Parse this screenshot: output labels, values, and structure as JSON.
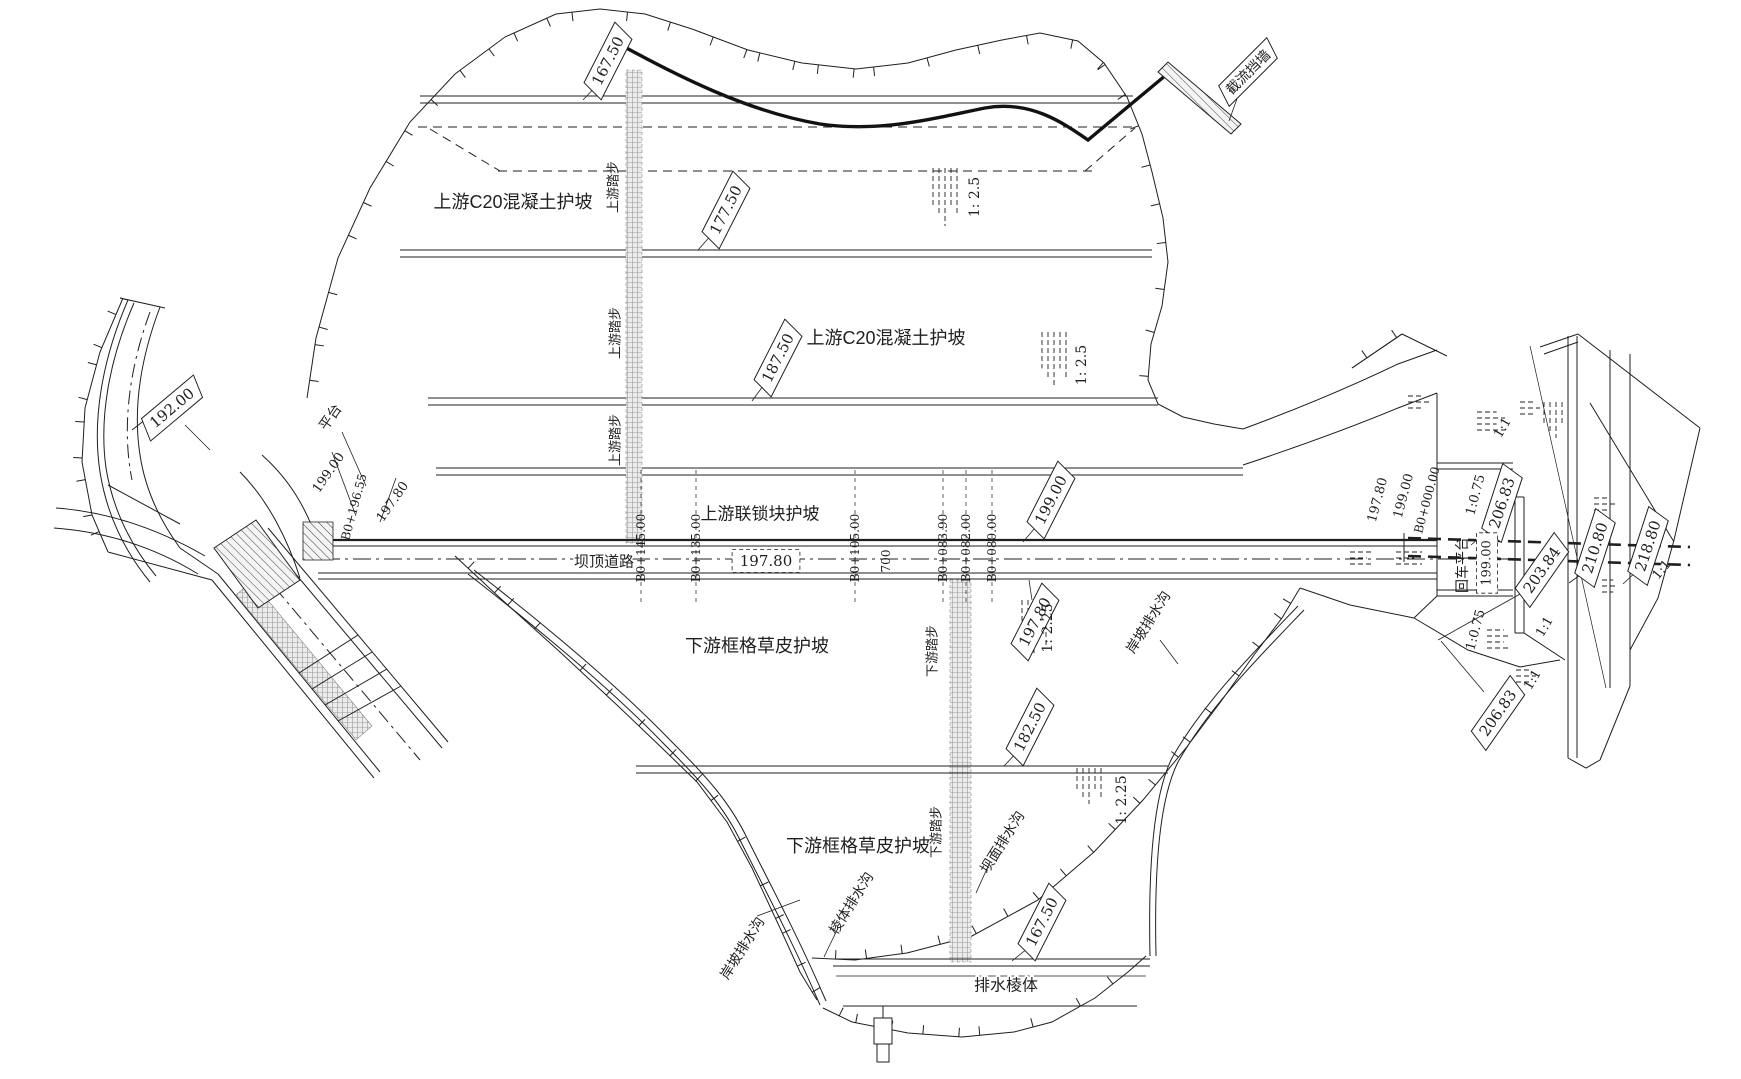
{
  "drawing": {
    "type": "engineering-plan",
    "subject": "dam plan view with spillway, crest road, slope protections and drainage",
    "ink_color": "#1f1f1f",
    "background": "#ffffff"
  },
  "labels": [
    {
      "t": "167.50",
      "x": 608,
      "y": 61,
      "r": -63,
      "s": "tag",
      "fs": 15,
      "n": "elev-tag-167-50-upstream"
    },
    {
      "t": "177.50",
      "x": 726,
      "y": 210,
      "r": -63,
      "s": "tag",
      "fs": 15,
      "n": "elev-tag-177-50"
    },
    {
      "t": "187.50",
      "x": 778,
      "y": 358,
      "r": -63,
      "s": "tag",
      "fs": 15,
      "n": "elev-tag-187-50"
    },
    {
      "t": "199.00",
      "x": 1051,
      "y": 500,
      "r": -63,
      "s": "tag",
      "fs": 15,
      "n": "elev-tag-199-00"
    },
    {
      "t": "197.80",
      "x": 1035,
      "y": 622,
      "r": -63,
      "s": "tag",
      "fs": 15,
      "n": "elev-tag-197-80-downstream"
    },
    {
      "t": "182.50",
      "x": 1030,
      "y": 727,
      "r": -63,
      "s": "tag",
      "fs": 15,
      "n": "elev-tag-182-50"
    },
    {
      "t": "167.50",
      "x": 1042,
      "y": 922,
      "r": -63,
      "s": "tag",
      "fs": 15,
      "n": "elev-tag-167-50-prism"
    },
    {
      "t": "192.00",
      "x": 172,
      "y": 408,
      "r": -40,
      "s": "tag",
      "fs": 15,
      "n": "elev-tag-192-00"
    },
    {
      "t": "206.83",
      "x": 1502,
      "y": 503,
      "r": -72,
      "s": "tag",
      "fs": 15,
      "n": "elev-tag-206-83-upper"
    },
    {
      "t": "203.84",
      "x": 1542,
      "y": 570,
      "r": -55,
      "s": "tag",
      "fs": 15,
      "n": "elev-tag-203-84"
    },
    {
      "t": "210.80",
      "x": 1595,
      "y": 548,
      "r": -72,
      "s": "tag",
      "fs": 15,
      "n": "elev-tag-210-80"
    },
    {
      "t": "218.80",
      "x": 1648,
      "y": 546,
      "r": -72,
      "s": "tag",
      "fs": 15,
      "n": "elev-tag-218-80"
    },
    {
      "t": "206.83",
      "x": 1498,
      "y": 713,
      "r": -55,
      "s": "tag",
      "fs": 15,
      "n": "elev-tag-206-83-lower"
    },
    {
      "t": "截流挡墙",
      "x": 1248,
      "y": 72,
      "r": -45,
      "s": "tag",
      "fs": 14,
      "n": "closure-wall-tag"
    },
    {
      "t": "197.80",
      "x": 766,
      "y": 561,
      "r": 0,
      "s": "dash",
      "fs": 15,
      "n": "crest-elev-box-197-80"
    },
    {
      "t": "199.00",
      "x": 1487,
      "y": 563,
      "r": -90,
      "s": "dash",
      "fs": 13,
      "n": "platform-elev-box-199-00"
    },
    {
      "t": "上游C20混凝土护坡",
      "x": 513,
      "y": 202,
      "r": 0,
      "s": "plain",
      "fs": 18,
      "n": "upstream-c20-concrete-slope-1"
    },
    {
      "t": "上游C20混凝土护坡",
      "x": 886,
      "y": 338,
      "r": 0,
      "s": "plain",
      "fs": 18,
      "n": "upstream-c20-concrete-slope-2"
    },
    {
      "t": "上游联锁块护坡",
      "x": 760,
      "y": 514,
      "r": 0,
      "s": "plain",
      "fs": 17,
      "n": "upstream-interlocking-block-slope"
    },
    {
      "t": "坝顶道路",
      "x": 604,
      "y": 562,
      "r": 0,
      "s": "plain",
      "fs": 15,
      "n": "dam-crest-road-label"
    },
    {
      "t": "下游框格草皮护坡",
      "x": 757,
      "y": 646,
      "r": 0,
      "s": "plain",
      "fs": 18,
      "n": "downstream-grid-grass-slope-1"
    },
    {
      "t": "下游框格草皮护坡",
      "x": 858,
      "y": 846,
      "r": 0,
      "s": "plain",
      "fs": 18,
      "n": "downstream-grid-grass-slope-2"
    },
    {
      "t": "排水棱体",
      "x": 1006,
      "y": 986,
      "r": 0,
      "s": "plain",
      "fs": 16,
      "n": "drainage-prism-label"
    },
    {
      "t": "上游踏步",
      "x": 613,
      "y": 187,
      "r": -90,
      "s": "plain",
      "fs": 13,
      "n": "upstream-steps-label-1"
    },
    {
      "t": "上游踏步",
      "x": 615,
      "y": 333,
      "r": -90,
      "s": "plain",
      "fs": 13,
      "n": "upstream-steps-label-2"
    },
    {
      "t": "上游踏步",
      "x": 615,
      "y": 440,
      "r": -90,
      "s": "plain",
      "fs": 13,
      "n": "upstream-steps-label-3"
    },
    {
      "t": "下游踏步",
      "x": 932,
      "y": 651,
      "r": -90,
      "s": "plain",
      "fs": 13,
      "n": "downstream-steps-label-1"
    },
    {
      "t": "下游踏步",
      "x": 936,
      "y": 832,
      "r": -90,
      "s": "plain",
      "fs": 13,
      "n": "downstream-steps-label-2"
    },
    {
      "t": "1: 2.5",
      "x": 975,
      "y": 197,
      "r": -90,
      "s": "plain",
      "fs": 14,
      "n": "slope-ratio-1-2-5-a"
    },
    {
      "t": "1: 2.5",
      "x": 1082,
      "y": 365,
      "r": -90,
      "s": "plain",
      "fs": 14,
      "n": "slope-ratio-1-2-5-b"
    },
    {
      "t": "1: 2.25",
      "x": 1048,
      "y": 628,
      "r": -90,
      "s": "plain",
      "fs": 14,
      "n": "slope-ratio-1-2-25-a"
    },
    {
      "t": "1: 2.25",
      "x": 1122,
      "y": 800,
      "r": -90,
      "s": "plain",
      "fs": 14,
      "n": "slope-ratio-1-2-25-b"
    },
    {
      "t": "回车平台",
      "x": 1462,
      "y": 565,
      "r": -90,
      "s": "plain",
      "fs": 14,
      "n": "turnaround-platform-label"
    },
    {
      "t": "700",
      "x": 886,
      "y": 561,
      "r": -90,
      "s": "plain",
      "fs": 12,
      "n": "dim-700"
    },
    {
      "t": "B0+145.00",
      "x": 641,
      "y": 548,
      "r": -90,
      "s": "plain",
      "fs": 12,
      "n": "station-b0-145-00"
    },
    {
      "t": "B0+135.00",
      "x": 696,
      "y": 548,
      "r": -90,
      "s": "plain",
      "fs": 12,
      "n": "station-b0-135-00"
    },
    {
      "t": "B0+105.00",
      "x": 855,
      "y": 548,
      "r": -90,
      "s": "plain",
      "fs": 12,
      "n": "station-b0-105-00"
    },
    {
      "t": "B0+083.90",
      "x": 943,
      "y": 548,
      "r": -90,
      "s": "plain",
      "fs": 12,
      "n": "station-b0-083-90"
    },
    {
      "t": "B0+082.00",
      "x": 966,
      "y": 548,
      "r": -90,
      "s": "plain",
      "fs": 12,
      "n": "station-b0-082-00"
    },
    {
      "t": "B0+080.00",
      "x": 992,
      "y": 548,
      "r": -90,
      "s": "plain",
      "fs": 12,
      "n": "station-b0-080-00"
    },
    {
      "t": "B0+196.55",
      "x": 354,
      "y": 507,
      "r": -75,
      "s": "plain",
      "fs": 12,
      "n": "station-b0-196-55"
    },
    {
      "t": "197.80",
      "x": 1378,
      "y": 500,
      "r": -75,
      "s": "plain",
      "fs": 13,
      "n": "elev-197-80-right"
    },
    {
      "t": "199.00",
      "x": 1404,
      "y": 496,
      "r": -75,
      "s": "plain",
      "fs": 13,
      "n": "elev-199-00-right"
    },
    {
      "t": "B0+000.00",
      "x": 1427,
      "y": 500,
      "r": -75,
      "s": "plain",
      "fs": 12,
      "n": "station-b0-000-00"
    },
    {
      "t": "1:0.75",
      "x": 1476,
      "y": 495,
      "r": -75,
      "s": "plain",
      "fs": 13,
      "n": "slope-ratio-1-0-75-a"
    },
    {
      "t": "1:0.75",
      "x": 1476,
      "y": 630,
      "r": -75,
      "s": "plain",
      "fs": 13,
      "n": "slope-ratio-1-0-75-b"
    },
    {
      "t": "平台",
      "x": 330,
      "y": 417,
      "r": -55,
      "s": "plain",
      "fs": 14,
      "n": "platform-label-left"
    },
    {
      "t": "199.00",
      "x": 329,
      "y": 473,
      "r": -55,
      "s": "plain",
      "fs": 13,
      "n": "elev-199-00-left"
    },
    {
      "t": "197.80",
      "x": 393,
      "y": 502,
      "r": -55,
      "s": "plain",
      "fs": 13,
      "n": "elev-197-80-left"
    },
    {
      "t": "1:1",
      "x": 1503,
      "y": 428,
      "r": -60,
      "s": "plain",
      "fs": 13,
      "n": "slope-ratio-1-1-a"
    },
    {
      "t": "1:1",
      "x": 1533,
      "y": 680,
      "r": -60,
      "s": "plain",
      "fs": 13,
      "n": "slope-ratio-1-1-b"
    },
    {
      "t": "1:1",
      "x": 1662,
      "y": 570,
      "r": -50,
      "s": "plain",
      "fs": 13,
      "n": "slope-ratio-1-1-c"
    },
    {
      "t": "1:1",
      "x": 1545,
      "y": 627,
      "r": -60,
      "s": "plain",
      "fs": 13,
      "n": "slope-ratio-1-1-d"
    },
    {
      "t": "坝面排水沟",
      "x": 1002,
      "y": 842,
      "r": -58,
      "s": "plain",
      "fs": 14,
      "n": "dam-face-drain-label"
    },
    {
      "t": "棱体排水沟",
      "x": 851,
      "y": 903,
      "r": -58,
      "s": "plain",
      "fs": 14,
      "n": "prism-drain-label"
    },
    {
      "t": "岸坡排水沟",
      "x": 742,
      "y": 948,
      "r": -58,
      "s": "plain",
      "fs": 14,
      "n": "bank-slope-drain-label-left"
    },
    {
      "t": "岸坡排水沟",
      "x": 1148,
      "y": 622,
      "r": -58,
      "s": "plain",
      "fs": 14,
      "n": "bank-slope-drain-label-right"
    }
  ]
}
